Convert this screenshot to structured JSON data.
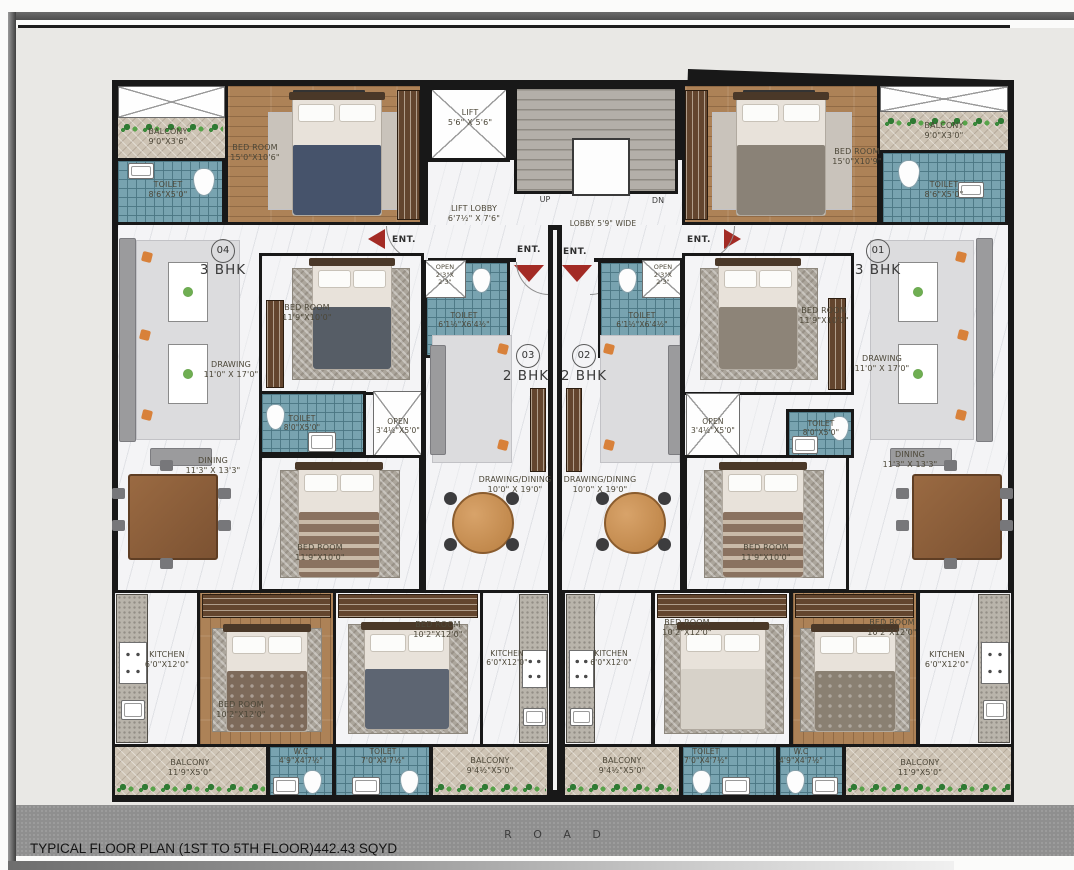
{
  "footer": {
    "caption": "TYPICAL FLOOR PLAN (1ST TO 5TH FLOOR)442.43 SQYD",
    "road": "R O A D"
  },
  "core": {
    "lift": {
      "name": "LIFT",
      "dims": "5'6\" X 5'6\""
    },
    "lift_lobby": {
      "name": "LIFT LOBBY",
      "dims": "6'7½\" X 7'6\""
    },
    "lobby_width": "LOBBY 5'9\" WIDE",
    "up": "UP",
    "dn": "DN",
    "ent": "ENT."
  },
  "units": {
    "u04": {
      "no": "04",
      "type": "3 BHK"
    },
    "u03": {
      "no": "03",
      "type": "2 BHK"
    },
    "u02": {
      "no": "02",
      "type": "2 BHK"
    },
    "u01": {
      "no": "01",
      "type": "3 BHK"
    }
  },
  "rooms": {
    "balcony_tl": {
      "name": "BALCONY",
      "dims": "9'0\"X3'6\""
    },
    "toilet_tl": {
      "name": "TOILET",
      "dims": "8'6\"X5'0\""
    },
    "bed_tl": {
      "name": "BED ROOM",
      "dims": "15'0\"X10'6\""
    },
    "bed_tr": {
      "name": "BED ROOM",
      "dims": "15'0\"X10'9\""
    },
    "balcony_tr": {
      "name": "BALCONY",
      "dims": "9'0\"X3'0\""
    },
    "toilet_tr": {
      "name": "TOILET",
      "dims": "8'6\"X5'0\""
    },
    "drawing_l": {
      "name": "DRAWING",
      "dims": "11'0\" X 17'0\""
    },
    "drawing_r": {
      "name": "DRAWING",
      "dims": "11'0\" X 17'0\""
    },
    "dining_l": {
      "name": "DINING",
      "dims": "11'3\" X 13'3\""
    },
    "dining_r": {
      "name": "DINING",
      "dims": "11'3\" X 13'3\""
    },
    "bed2_l": {
      "name": "BED ROOM",
      "dims": "11'9\"X10'0\""
    },
    "bed2_r": {
      "name": "BED ROOM",
      "dims": "11'9\"X10'0\""
    },
    "bed3_l": {
      "name": "BED ROOM",
      "dims": "11'9\"X10'0\""
    },
    "bed3_r": {
      "name": "BED ROOM",
      "dims": "11'9\"X10'0\""
    },
    "toilet2_l": {
      "name": "TOILET",
      "dims": "8'0\"X5'0\""
    },
    "toilet2_r": {
      "name": "TOILET",
      "dims": "8'0\"X5'0\""
    },
    "open_l": {
      "name": "OPEN",
      "dims": "3'4½\"X5'0\""
    },
    "open_r": {
      "name": "OPEN",
      "dims": "3'4½\"X5'0\""
    },
    "open_03": {
      "name": "OPEN",
      "dims": "2'3\"X",
      "dims2": "2'3\""
    },
    "open_02": {
      "name": "OPEN",
      "dims": "2'3\"X",
      "dims2": "2'3\""
    },
    "toilet_03": {
      "name": "TOILET",
      "dims": "6'1½\"X6'4½\""
    },
    "toilet_02": {
      "name": "TOILET",
      "dims": "6'1½\"X6'4½\""
    },
    "dd_03": {
      "name": "DRAWING/DINING",
      "dims": "10'0\" X 19'0\""
    },
    "dd_02": {
      "name": "DRAWING/DINING",
      "dims": "10'0\" X 19'0\""
    },
    "kitchen_l": {
      "name": "KITCHEN",
      "dims": "6'0\"X12'0\""
    },
    "kitchen_03": {
      "name": "KITCHEN",
      "dims": "6'0\"X12'0\""
    },
    "kitchen_02": {
      "name": "KITCHEN",
      "dims": "6'0\"X12'0\""
    },
    "kitchen_r": {
      "name": "KITCHEN",
      "dims": "6'0\"X12'0\""
    },
    "bed4_l": {
      "name": "BED ROOM",
      "dims": "10'2\"X12'0\""
    },
    "bed5_l": {
      "name": "BED ROOM",
      "dims": "10'2\"X12'0\""
    },
    "bed5_r": {
      "name": "BED ROOM",
      "dims": "10'2\"X12'0\""
    },
    "bed4_r": {
      "name": "BED ROOM",
      "dims": "10'2\"X12'0\""
    },
    "balcony_bl": {
      "name": "BALCONY",
      "dims": "11'9\"X5'0\""
    },
    "wc_l": {
      "name": "W.C",
      "dims": "4'9\"X4'7½\""
    },
    "toilet_bl": {
      "name": "TOILET",
      "dims": "7'0\"X4'7½\""
    },
    "balcony_bcl": {
      "name": "BALCONY",
      "dims": "9'4½\"X5'0\""
    },
    "balcony_bcr": {
      "name": "BALCONY",
      "dims": "9'4½\"X5'0\""
    },
    "toilet_br": {
      "name": "TOILET",
      "dims": "7'0\"X4'7½\""
    },
    "wc_r": {
      "name": "W.C",
      "dims": "4'9\"X4'7½\""
    },
    "balcony_br": {
      "name": "BALCONY",
      "dims": "11'9\"X5'0\""
    }
  },
  "colors": {
    "wall": "#181818",
    "tile_teal": "#78a3b0",
    "wood": "#ad8257",
    "balcony_tan": "#cec4b5",
    "marble": "#f4f4f6",
    "road_gray": "#8f8f8f",
    "entry_arrow_red": "#a32b25"
  }
}
